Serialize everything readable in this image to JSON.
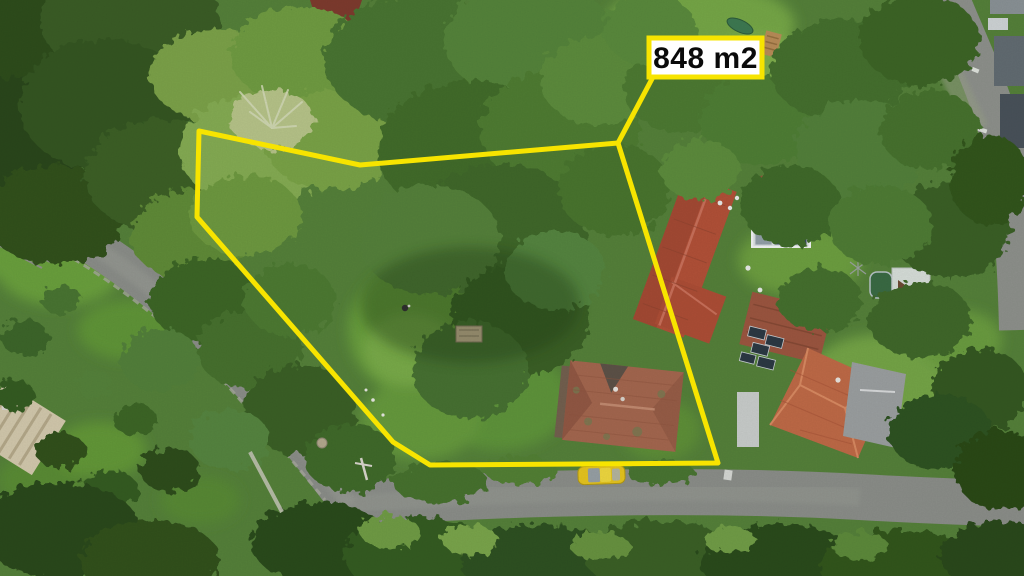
{
  "annotation": {
    "area_label": "848 m2",
    "boundary_points": "199,131 360,165 618,143 718,463 430,465 393,442 197,217",
    "leader_points": "618,143 653,77",
    "colors": {
      "boundary": "#f7e400",
      "label_bg": "#ffffff",
      "label_border": "#f7e400",
      "label_text": "#0a0a0a"
    }
  },
  "scene": {
    "type": "aerial-drone-photograph",
    "features": [
      "dense tree canopy covering plot",
      "curved asphalt road on left with junction at bottom",
      "road along right edge",
      "red tiled roof house at plot edge",
      "weathered red hip-roof house inside plot",
      "orange hip-roof house with flat grey annex at right",
      "solar panel canopy in garden",
      "garden lawns and hedgerows",
      "yellow car parked on bottom road"
    ],
    "palette": {
      "forest_dark": "#2e4d1f",
      "foliage_mid": "#4a7530",
      "lawn": "#6aa03d",
      "road": "#8b8e89",
      "roof_red": "#b25138",
      "roof_orange": "#bf6a47",
      "solar_panel": "#3a4b5c",
      "car_yellow": "#e6c51f"
    }
  }
}
